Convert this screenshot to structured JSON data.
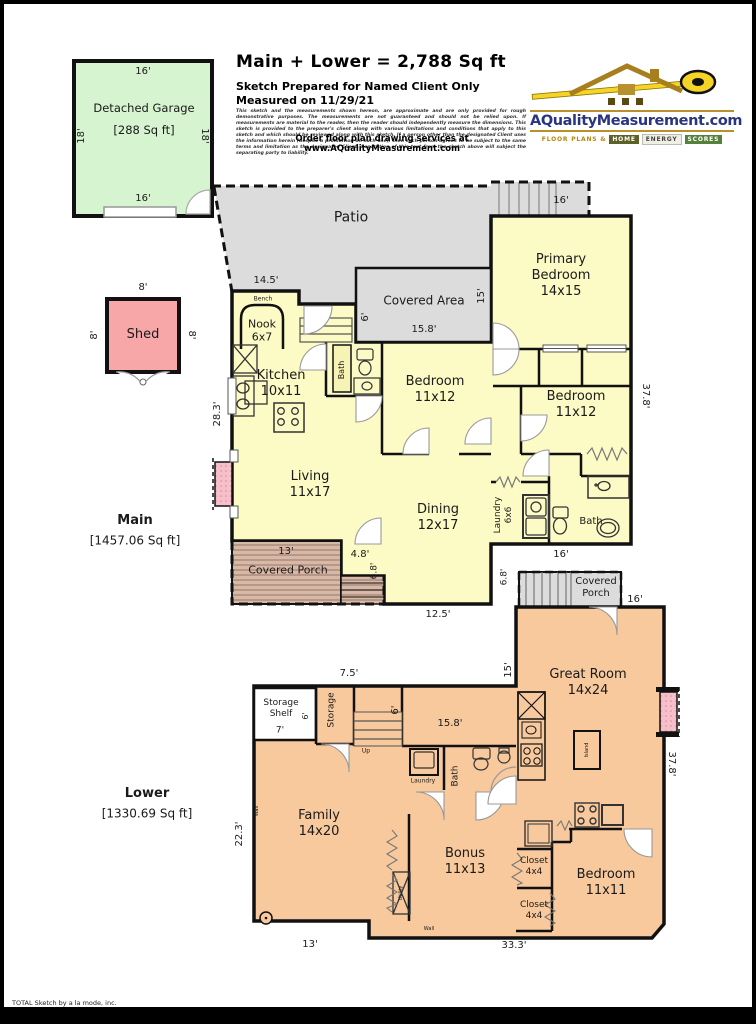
{
  "header": {
    "title": "Main + Lower = 2,788  Sq ft",
    "prepared": "Sketch Prepared for Named Client Only",
    "measured": "Measured on 11/29/21",
    "disclaimer": "This sketch and the measurements shown hereon, are approximate and are only provided for rough demonstrative purposes.  The measurements are not guaranteed and should not be relied upon.  If measurements are material to the reader, then the reader should independently measure the dimensions.  This sketch is provided to the preparer's client along with various limitations and conditions that apply to this sketch and which should be reviewed along with this sketch.  If a person other than the designated Client uses the information herein (despite a prohibition on such use), then such person agrees to be subject to the same terms and limitation as the designated Client.  Separation of this text from the sketch above will subject the separating party to liability.",
    "order_line": "Order floor plan drawing services at www.AQualityMeasurement.com"
  },
  "logo": {
    "domain": "AQualityMeasurement.com",
    "tagline_prefix": "Floor Plans &",
    "tagline_words": [
      "Home",
      "Energy",
      "Scores"
    ]
  },
  "footer": "TOTAL Sketch by a la mode, inc.",
  "palette": {
    "garage_green": "#d6f4cf",
    "shed_pink": "#f7a7a7",
    "main_yellow": "#fcfac5",
    "lower_orange": "#f8c99d",
    "outdoor_gray": "#dcdcdc",
    "porch_tan": "#d8b9a8",
    "fireplace_pink": "#f6bfc9",
    "wall_black": "#111111",
    "logo_navy": "#2a3580",
    "logo_gold": "#b8860b",
    "logo_green": "#55813c"
  },
  "plan_labels": [
    {
      "name": "dim-garage-top",
      "text": "16'",
      "x": 139,
      "y": 68,
      "size": 10
    },
    {
      "name": "room-detached-garage",
      "text": "Detached Garage",
      "x": 140,
      "y": 104,
      "size": 11.5
    },
    {
      "name": "area-detached-garage",
      "text": "[288 Sq ft]",
      "x": 140,
      "y": 126,
      "size": 11.5
    },
    {
      "name": "dim-garage-left",
      "text": "18'",
      "x": 78,
      "y": 132,
      "size": 10,
      "rot": -90
    },
    {
      "name": "dim-garage-right",
      "text": "18'",
      "x": 200,
      "y": 132,
      "size": 10,
      "rot": 90
    },
    {
      "name": "dim-garage-bottom",
      "text": "16'",
      "x": 139,
      "y": 195,
      "size": 10
    },
    {
      "name": "dim-shed-top",
      "text": "8'",
      "x": 139,
      "y": 284,
      "size": 10
    },
    {
      "name": "dim-shed-left",
      "text": "8'",
      "x": 91,
      "y": 331,
      "size": 10,
      "rot": -90
    },
    {
      "name": "dim-shed-right",
      "text": "8'",
      "x": 187,
      "y": 331,
      "size": 10,
      "rot": 90
    },
    {
      "name": "room-shed",
      "text": "Shed",
      "x": 139,
      "y": 331,
      "size": 13
    },
    {
      "name": "room-patio",
      "text": "Patio",
      "x": 347,
      "y": 214,
      "size": 14
    },
    {
      "name": "dim-deck-top",
      "text": "16'",
      "x": 557,
      "y": 197,
      "size": 10
    },
    {
      "name": "room-primary-bedroom",
      "text": "Primary\nBedroom\n14x15",
      "x": 557,
      "y": 272,
      "size": 13
    },
    {
      "name": "dim-nook-top",
      "text": "14.5'",
      "x": 262,
      "y": 277,
      "size": 10
    },
    {
      "name": "label-bench",
      "text": "Bench",
      "x": 259,
      "y": 295,
      "size": 6
    },
    {
      "name": "room-nook",
      "text": "Nook\n6x7",
      "x": 258,
      "y": 327,
      "size": 11
    },
    {
      "name": "room-covered-area",
      "text": "Covered Area",
      "x": 420,
      "y": 297,
      "size": 12
    },
    {
      "name": "dim-covered-area-width",
      "text": "15.8'",
      "x": 420,
      "y": 326,
      "size": 10
    },
    {
      "name": "dim-covered-area-right",
      "text": "15'",
      "x": 478,
      "y": 292,
      "size": 10,
      "rot": -90
    },
    {
      "name": "dim-covered-area-left",
      "text": "6'",
      "x": 362,
      "y": 313,
      "size": 10,
      "rot": -90
    },
    {
      "name": "room-kitchen",
      "text": "Kitchen\n10x11",
      "x": 277,
      "y": 380,
      "size": 13
    },
    {
      "name": "room-bath-main-hall",
      "text": "Bath",
      "x": 338,
      "y": 366,
      "size": 8,
      "rot": -90
    },
    {
      "name": "room-bedroom-1",
      "text": "Bedroom\n11x12",
      "x": 431,
      "y": 386,
      "size": 13
    },
    {
      "name": "room-bedroom-2",
      "text": "Bedroom\n11x12",
      "x": 572,
      "y": 401,
      "size": 13
    },
    {
      "name": "dim-main-right",
      "text": "37.8'",
      "x": 641,
      "y": 392,
      "size": 10,
      "rot": 90
    },
    {
      "name": "dim-main-left",
      "text": "28.3'",
      "x": 214,
      "y": 410,
      "size": 10,
      "rot": -90
    },
    {
      "name": "room-living",
      "text": "Living\n11x17",
      "x": 306,
      "y": 481,
      "size": 13
    },
    {
      "name": "room-dining",
      "text": "Dining\n12x17",
      "x": 434,
      "y": 514,
      "size": 13
    },
    {
      "name": "room-laundry-main",
      "text": "Laundry\n6x6",
      "x": 500,
      "y": 511,
      "size": 9,
      "rot": -90
    },
    {
      "name": "room-bath-main",
      "text": "Bath",
      "x": 587,
      "y": 518,
      "size": 10
    },
    {
      "name": "label-main-level",
      "text": "Main",
      "x": 131,
      "y": 517,
      "size": 13,
      "bold": true
    },
    {
      "name": "area-main-level",
      "text": "[1457.06 Sq ft]",
      "x": 131,
      "y": 537,
      "size": 12
    },
    {
      "name": "dim-porch-width",
      "text": "13'",
      "x": 282,
      "y": 548,
      "size": 10
    },
    {
      "name": "room-covered-porch-main",
      "text": "Covered Porch",
      "x": 284,
      "y": 566,
      "size": 11
    },
    {
      "name": "dim-porch-step",
      "text": "4.8'",
      "x": 356,
      "y": 551,
      "size": 10
    },
    {
      "name": "dim-porch-depth",
      "text": "6.8'",
      "x": 371,
      "y": 567,
      "size": 9,
      "rot": -90
    },
    {
      "name": "dim-main-bottom",
      "text": "12.5'",
      "x": 434,
      "y": 611,
      "size": 10
    },
    {
      "name": "dim-main-bath-bottom",
      "text": "16'",
      "x": 557,
      "y": 551,
      "size": 10
    },
    {
      "name": "dim-lower-porch-left",
      "text": "6.8'",
      "x": 501,
      "y": 573,
      "size": 9,
      "rot": -90
    },
    {
      "name": "room-covered-porch-lower",
      "text": "Covered\nPorch",
      "x": 592,
      "y": 584,
      "size": 10
    },
    {
      "name": "dim-lower-porch-right",
      "text": "16'",
      "x": 631,
      "y": 596,
      "size": 10
    },
    {
      "name": "room-great-room",
      "text": "Great Room\n14x24",
      "x": 584,
      "y": 679,
      "size": 13
    },
    {
      "name": "dim-great-room-left",
      "text": "15'",
      "x": 505,
      "y": 666,
      "size": 10,
      "rot": -90
    },
    {
      "name": "dim-storage-top",
      "text": "7.5'",
      "x": 345,
      "y": 670,
      "size": 10
    },
    {
      "name": "room-storage-shelf",
      "text": "Storage\nShelf",
      "x": 277,
      "y": 705,
      "size": 9
    },
    {
      "name": "dim-storage-shelf",
      "text": "6'",
      "x": 302,
      "y": 712,
      "size": 8,
      "rot": -90
    },
    {
      "name": "dim-storage-shelf-w",
      "text": "7'",
      "x": 276,
      "y": 727,
      "size": 9
    },
    {
      "name": "room-storage",
      "text": "Storage",
      "x": 328,
      "y": 706,
      "size": 9,
      "rot": -90
    },
    {
      "name": "label-stairs-up",
      "text": "Up",
      "x": 362,
      "y": 747,
      "size": 6
    },
    {
      "name": "dim-stairs-right",
      "text": "6'",
      "x": 392,
      "y": 706,
      "size": 10,
      "rot": -90
    },
    {
      "name": "dim-lower-hall",
      "text": "15.8'",
      "x": 446,
      "y": 720,
      "size": 10
    },
    {
      "name": "room-laundry-lower",
      "text": "Laundry",
      "x": 419,
      "y": 777,
      "size": 6
    },
    {
      "name": "room-bath-lower",
      "text": "Bath",
      "x": 452,
      "y": 772,
      "size": 9,
      "rot": -90
    },
    {
      "name": "label-island",
      "text": "Island",
      "x": 583,
      "y": 746,
      "size": 5,
      "rot": -90
    },
    {
      "name": "dim-lower-right",
      "text": "37.8'",
      "x": 667,
      "y": 760,
      "size": 10,
      "rot": 90
    },
    {
      "name": "room-family",
      "text": "Family\n14x20",
      "x": 315,
      "y": 820,
      "size": 13
    },
    {
      "name": "room-bonus",
      "text": "Bonus\n11x13",
      "x": 461,
      "y": 858,
      "size": 13
    },
    {
      "name": "label-utility",
      "text": "Utility",
      "x": 397,
      "y": 889,
      "size": 5,
      "rot": -90
    },
    {
      "name": "label-wall-left",
      "text": "Wall",
      "x": 253,
      "y": 807,
      "size": 5,
      "rot": -90
    },
    {
      "name": "label-wall-bottom",
      "text": "Wall",
      "x": 425,
      "y": 925,
      "size": 5
    },
    {
      "name": "room-closet-1",
      "text": "Closet\n4x4",
      "x": 530,
      "y": 863,
      "size": 9
    },
    {
      "name": "room-closet-2",
      "text": "Closet\n4x4",
      "x": 530,
      "y": 907,
      "size": 9
    },
    {
      "name": "room-bedroom-lower",
      "text": "Bedroom\n11x11",
      "x": 602,
      "y": 879,
      "size": 13
    },
    {
      "name": "dim-lower-left",
      "text": "22.3'",
      "x": 236,
      "y": 830,
      "size": 10,
      "rot": -90
    },
    {
      "name": "label-lower-level",
      "text": "Lower",
      "x": 143,
      "y": 790,
      "size": 13,
      "bold": true
    },
    {
      "name": "area-lower-level",
      "text": "[1330.69 Sq ft]",
      "x": 143,
      "y": 810,
      "size": 12
    },
    {
      "name": "dim-lower-bottom-left",
      "text": "13'",
      "x": 306,
      "y": 941,
      "size": 10
    },
    {
      "name": "dim-lower-bottom",
      "text": "33.3'",
      "x": 510,
      "y": 942,
      "size": 10
    }
  ]
}
